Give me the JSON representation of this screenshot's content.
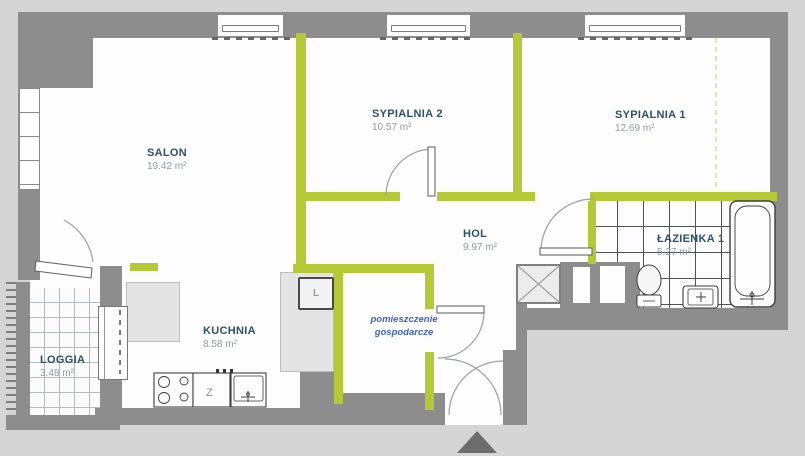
{
  "plan": {
    "title": "apartment-floor-plan",
    "rooms": [
      {
        "name": "SALON",
        "area": "19.42 m²"
      },
      {
        "name": "SYPIALNIA 2",
        "area": "10.57 m²"
      },
      {
        "name": "SYPIALNIA 1",
        "area": "12.69 m²"
      },
      {
        "name": "HOL",
        "area": "9.97 m²"
      },
      {
        "name": "ŁAZIENKA 1",
        "area": "5.27 m²"
      },
      {
        "name": "KUCHNIA",
        "area": "8.58 m²"
      },
      {
        "name": "LOGGIA",
        "area": "3.48 m²"
      }
    ],
    "utility": {
      "line1": "pomieszczenie",
      "line2": "gospodarcze"
    },
    "fixtures": {
      "fridge_label": "L",
      "sink_label": "Z"
    },
    "colors": {
      "background": "#d5d5d5",
      "wall_gray": "#8d8d8d",
      "partition_green": "#b5c937",
      "room_label": "#2b516e",
      "area_text": "#8d9aa9",
      "utility_text": "#3e61c5",
      "entrance_arrow": "#6d6d6d"
    }
  }
}
